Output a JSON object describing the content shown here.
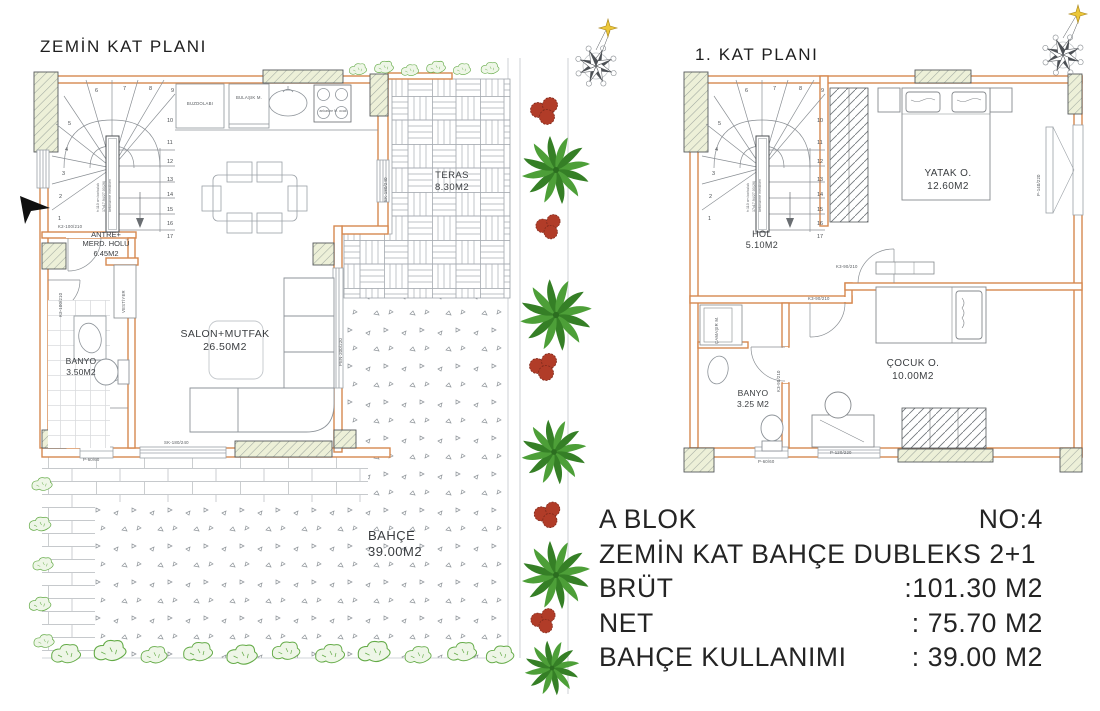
{
  "colors": {
    "wall_orange": "#d6884f",
    "column_fill": "#edf0d8",
    "line_gray": "#9aa0a6",
    "plant_green": "#4d9f38",
    "flower_red": "#b13c28",
    "text_dark": "#242424"
  },
  "left_plan": {
    "title": "ZEMİN KAT PLANI",
    "rooms": {
      "teras": {
        "name": "TERAS",
        "area": "8.30M2"
      },
      "salon": {
        "name": "SALON+MUTFAK",
        "area": "26.50M2"
      },
      "antre": {
        "line1": "ANTRE+",
        "line2": "MERD. HOLÜ",
        "area": "6.45M2"
      },
      "banyo": {
        "name": "BANYO",
        "area": "3.50M2"
      },
      "bahce": {
        "name": "BAHÇE",
        "area": "39.00M2"
      }
    },
    "labels": {
      "buzdolabi": "BUZDOLABI",
      "bulasik": "BULAŞIK M.",
      "ocak": "ankastre M. ocak",
      "vestiyer": "VESTİYER",
      "door_antre": "K2-100/210",
      "door_left": "K2-100/210",
      "window_kitchen": "SK-180/240",
      "window_salon": "PEN-200/220",
      "window_bottom": "SK-180/240",
      "window_small": "P-60/60"
    }
  },
  "right_plan": {
    "title": "1. KAT PLANI",
    "rooms": {
      "yatak": {
        "name": "YATAK O.",
        "area": "12.60M2"
      },
      "hol": {
        "name": "HOL",
        "area": "5.10M2"
      },
      "cocuk": {
        "name": "ÇOCUK O.",
        "area": "10.00M2"
      },
      "banyo": {
        "name": "BANYO",
        "area": "3.25 M2"
      }
    },
    "labels": {
      "camasir": "ÇAMAŞIR M.",
      "door_yatak": "K3-90/210",
      "door_cocuk": "K3-90/210",
      "door_banyo": "K3-90/210",
      "window_right": "P-140/220",
      "window_bottom": "P-120/220",
      "window_small": "P-60/60"
    }
  },
  "stairs": {
    "numbers": [
      "1",
      "2",
      "3",
      "4",
      "5",
      "6",
      "7",
      "8",
      "9",
      "10",
      "11",
      "12",
      "13",
      "14",
      "15",
      "16",
      "17"
    ],
    "note1": "h:110 cm korkuluk",
    "note2": "17x17.94/27.03(26)",
    "note3": "betonarme merdiven"
  },
  "info": {
    "block": "A BLOK",
    "no": "NO:4",
    "type": "ZEMİN KAT BAHÇE DUBLEKS 2+1",
    "rows": [
      {
        "label": "BRÜT",
        "value": ":101.30 M2"
      },
      {
        "label": "NET",
        "value": ": 75.70  M2"
      },
      {
        "label": "BAHÇE KULLANIMI",
        "value": ": 39.00  M2"
      }
    ]
  }
}
